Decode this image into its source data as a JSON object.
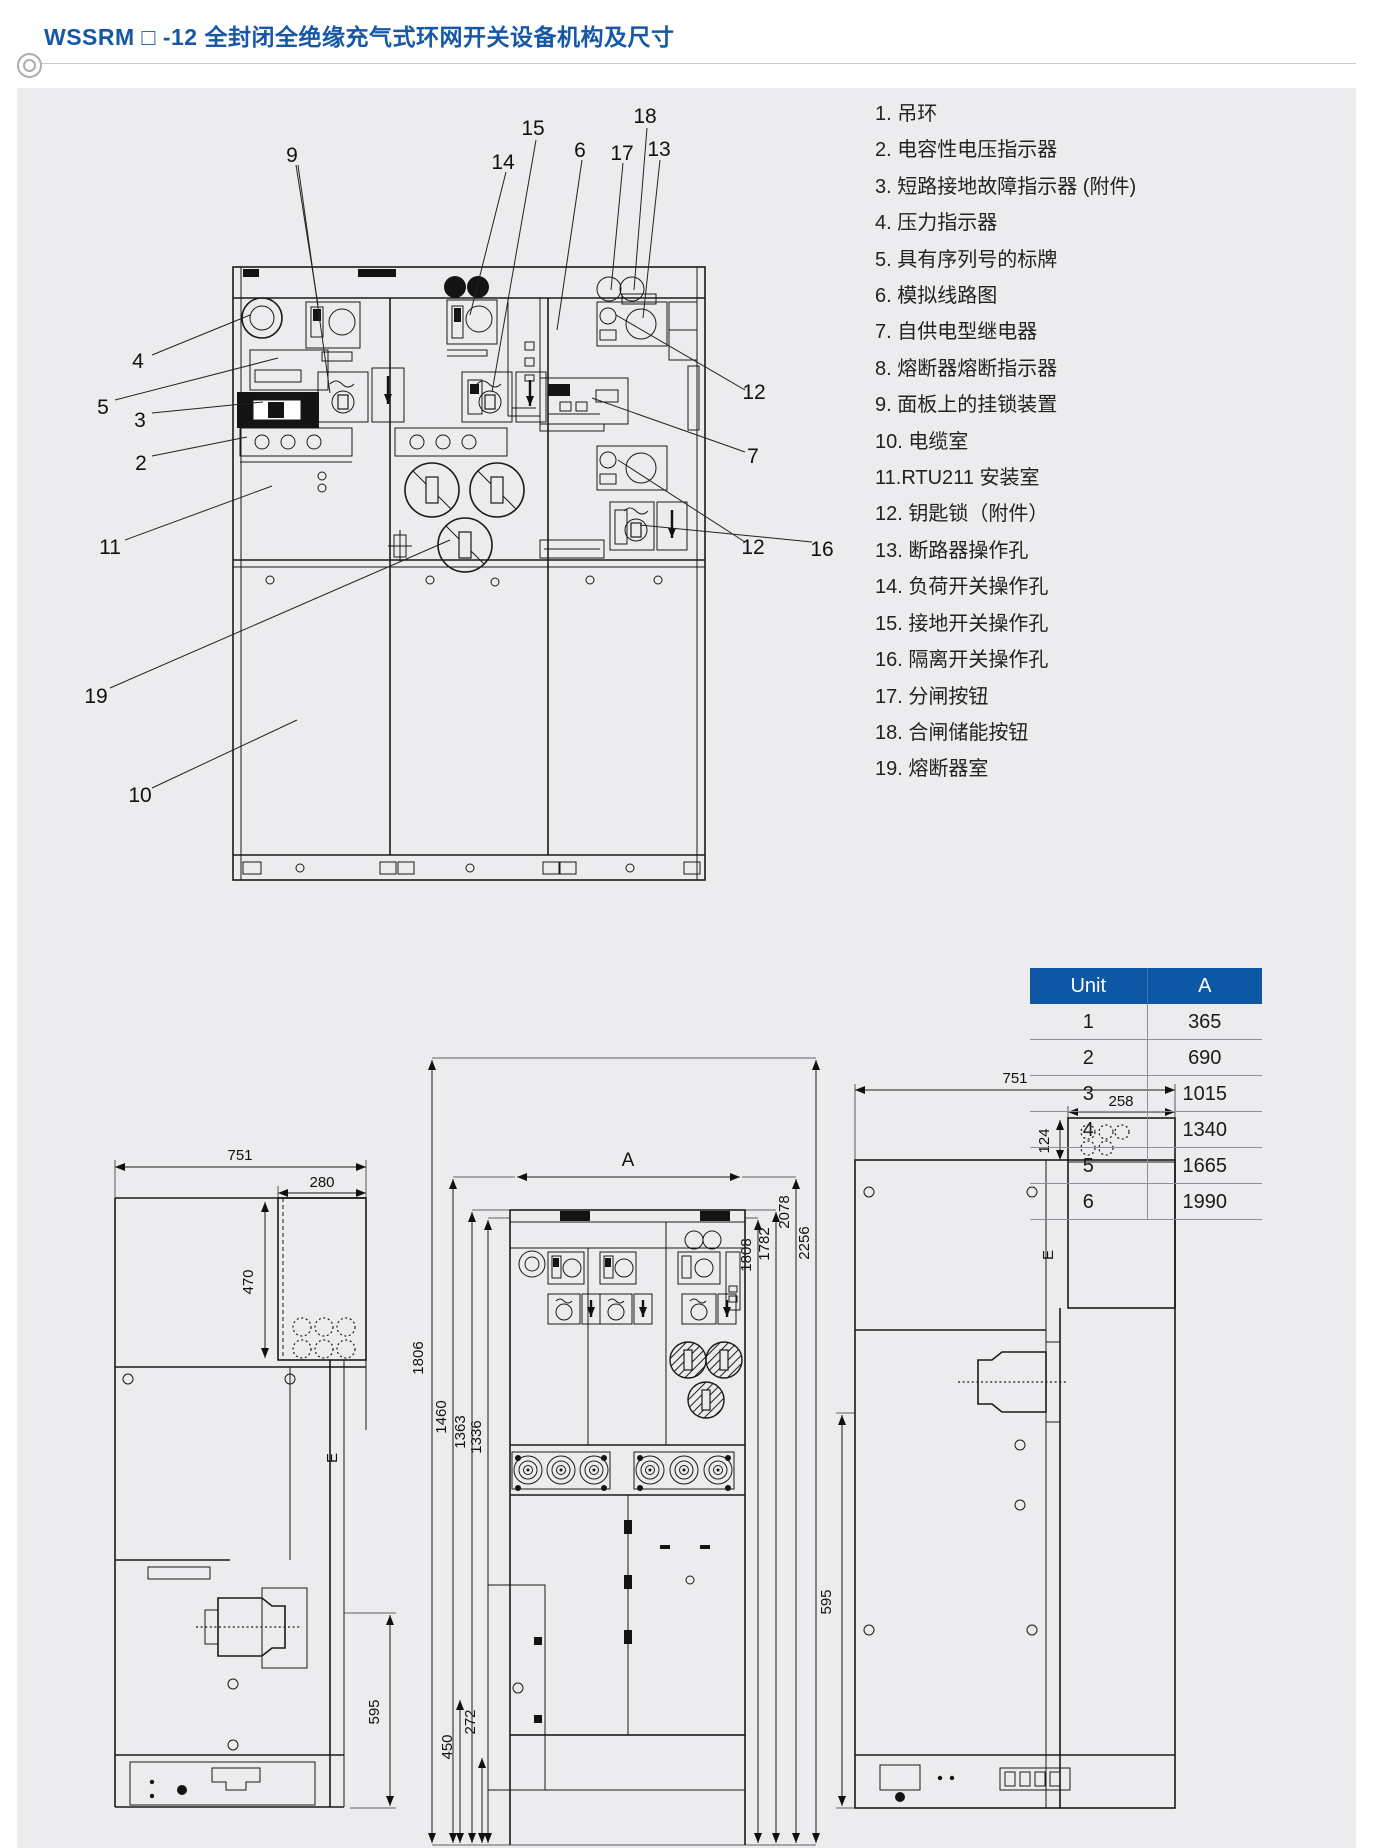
{
  "page": {
    "title": "WSSRM □ -12 全封闭全绝缘充气式环网开关设备机构及尺寸"
  },
  "colors": {
    "accent_blue": "#1658A5",
    "table_header_blue": "#0E57A5",
    "panel_bg": "#ECECEE",
    "line": "#1A1A1A"
  },
  "legend": {
    "items": [
      "1. 吊环",
      "2. 电容性电压指示器",
      "3. 短路接地故障指示器 (附件)",
      "4. 压力指示器",
      "5. 具有序列号的标牌",
      "6. 模拟线路图",
      "7. 自供电型继电器",
      "8. 熔断器熔断指示器",
      "9. 面板上的挂锁装置",
      "10. 电缆室",
      "11.RTU211 安装室",
      "12. 钥匙锁（附件）",
      "13. 断路器操作孔",
      "14. 负荷开关操作孔",
      "15. 接地开关操作孔",
      "16. 隔离开关操作孔",
      "17. 分闸按钮",
      "18. 合闸储能按钮",
      "19. 熔断器室"
    ]
  },
  "callouts": {
    "c2": "2",
    "c3": "3",
    "c4": "4",
    "c5": "5",
    "c6": "6",
    "c7": "7",
    "c9": "9",
    "c10": "10",
    "c11": "11",
    "c12a": "12",
    "c12b": "12",
    "c13": "13",
    "c14": "14",
    "c15": "15",
    "c16": "16",
    "c17": "17",
    "c18": "18",
    "c19": "19"
  },
  "table": {
    "headers": [
      "Unit",
      "A"
    ],
    "rows": [
      {
        "unit": "1",
        "a": "365"
      },
      {
        "unit": "2",
        "a": "690"
      },
      {
        "unit": "3",
        "a": "1015"
      },
      {
        "unit": "4",
        "a": "1340"
      },
      {
        "unit": "5",
        "a": "1665"
      },
      {
        "unit": "6",
        "a": "1990"
      }
    ]
  },
  "dims": {
    "left_view": {
      "width": "751",
      "top_width": "280",
      "upper_height": "470",
      "lower_height": "595",
      "section": "E"
    },
    "front_view": {
      "width_label": "A",
      "left_heights": [
        "1806",
        "1460",
        "1363",
        "1336"
      ],
      "right_heights": [
        "1808",
        "1782",
        "2078",
        "2256"
      ],
      "duct_depths": [
        "450",
        "272"
      ]
    },
    "right_view": {
      "width": "751",
      "top_width": "258",
      "box_height": "124",
      "lower_height": "595",
      "section": "E"
    }
  }
}
